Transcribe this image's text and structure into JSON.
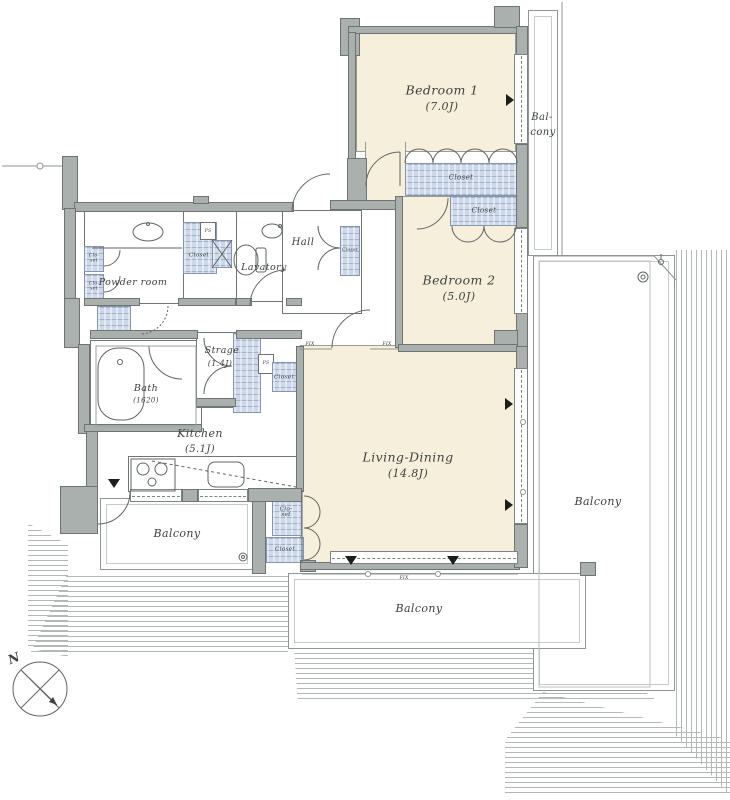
{
  "rooms": {
    "bedroom1": {
      "name": "Bedroom 1",
      "size": "(7.0J)"
    },
    "bedroom2": {
      "name": "Bedroom 2",
      "size": "(5.0J)"
    },
    "living_dining": {
      "name": "Living-Dining",
      "size": "(14.8J)"
    },
    "kitchen": {
      "name": "Kitchen",
      "size": "(5.1J)"
    },
    "storage": {
      "name": "Strage",
      "size": "(1.4J)"
    },
    "bath": {
      "name": "Bath",
      "size": "(1620)"
    },
    "powder_room": {
      "name": "Powder room"
    },
    "lavatory": {
      "name": "Lavatory"
    },
    "hall": {
      "name": "Hall"
    }
  },
  "balconies": {
    "right": "Balcony",
    "bottom": "Balcony",
    "left": "Balcony",
    "top_right_line1": "Bal-",
    "top_right_line2": "cony"
  },
  "fixture_labels": {
    "closet": "Closet",
    "closet_line1": "Clo-",
    "closet_line2": "set",
    "pipe_space": "PS",
    "fixed_window": "FIX"
  },
  "compass": {
    "north_label": "N"
  },
  "colors": {
    "wall_fill": "#a9b0ae",
    "wall_edge": "#6d7472",
    "room_fill": "#f6efdc",
    "closet_fill": "#cdd9e9",
    "closet_edge": "#8595b2",
    "hatch_line": "#b2b8b6",
    "ink": "#3d423f"
  }
}
